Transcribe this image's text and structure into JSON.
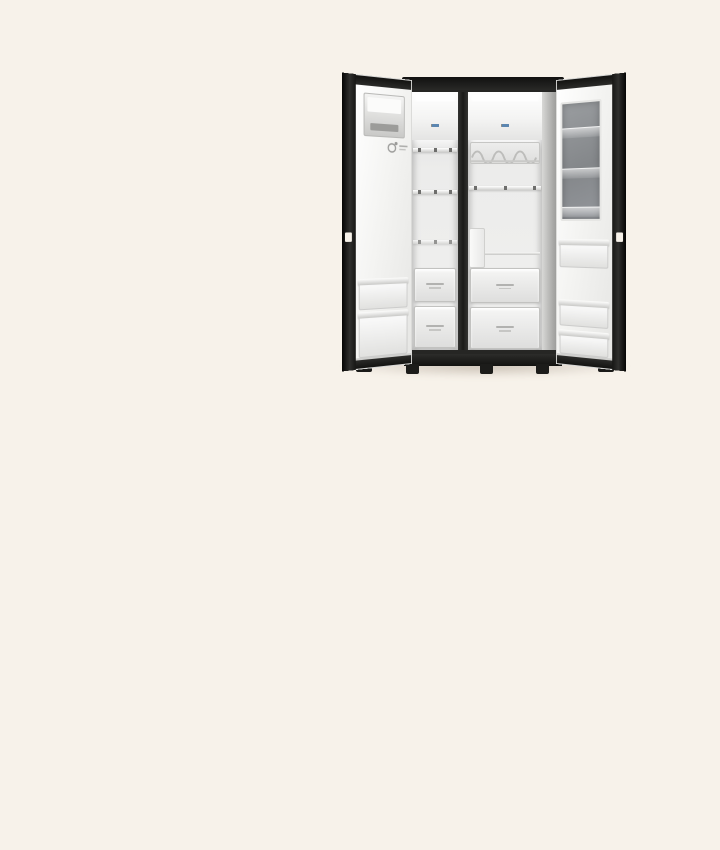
{
  "scene": {
    "subject": "open-side-by-side-refrigerator-product-photo",
    "visible_text": "none-legible"
  },
  "colors": {
    "background": "#F7F2EA",
    "door_black": "#1E1E1C",
    "door_face": "#FBFBFA",
    "frame_dark": "#262624",
    "interior_wall": "#E9E9E8",
    "shelf_line": "#C8C8C6",
    "clip_dark": "#6E6E6C",
    "glass_panel": "#8D9093",
    "drawer_face": "#EDEDEC",
    "label_blue": "#5B86B0",
    "label_gray": "#8C8C8A",
    "base_black": "#161614"
  },
  "refrigerator": {
    "left_door": {
      "parts": [
        "door-edge",
        "hinge-notch",
        "ice-maker-box",
        "brand-badge",
        "door-bin",
        "door-bin"
      ]
    },
    "freezer_compartment": {
      "parts": [
        "led-light-bar",
        "brand-label-mark",
        "shelf",
        "shelf",
        "shelf",
        "drawer",
        "drawer"
      ]
    },
    "fridge_compartment": {
      "parts": [
        "led-light-bar",
        "brand-label-mark",
        "wine-rack-shelf",
        "shelf",
        "drawer-rail",
        "filter-box",
        "drawer",
        "drawer"
      ]
    },
    "right_door": {
      "parts": [
        "instaview-glass-panel",
        "glass-shelf-bin",
        "glass-shelf-bin",
        "glass-shelf-bin",
        "door-bin",
        "door-bin",
        "door-edge",
        "hinge-notch"
      ]
    },
    "base": {
      "parts": [
        "plinth",
        "leveling-foot",
        "leveling-foot",
        "leveling-foot",
        "door-caster",
        "door-caster",
        "floor-shadow"
      ]
    }
  }
}
